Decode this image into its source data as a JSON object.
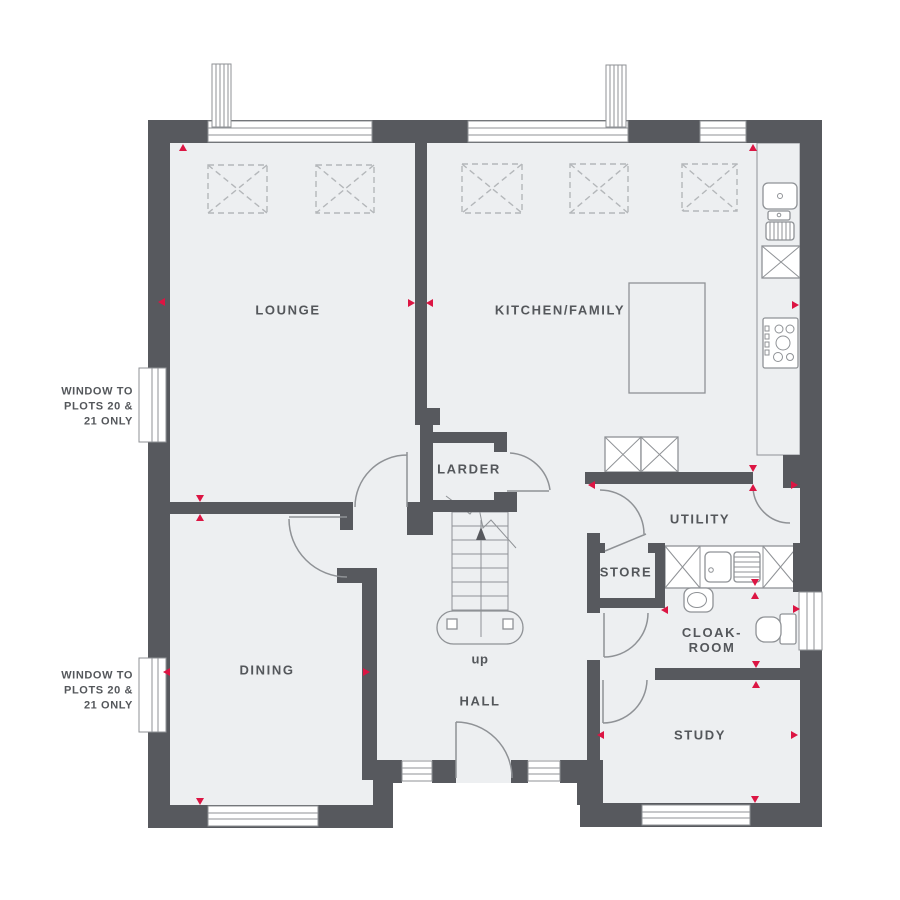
{
  "colors": {
    "wall": "#57595e",
    "floor": "#edeff1",
    "line": "#8f9296",
    "dash": "#b4b7ba",
    "accent": "#dc1543",
    "text": "#54575b"
  },
  "rooms": {
    "lounge": {
      "label": "LOUNGE"
    },
    "kitchen": {
      "label": "KITCHEN/FAMILY"
    },
    "larder": {
      "label": "LARDER"
    },
    "utility": {
      "label": "UTILITY"
    },
    "store": {
      "label": "STORE"
    },
    "cloakroom": {
      "label": "CLOAK-\nROOM"
    },
    "dining": {
      "label": "DINING"
    },
    "hall": {
      "label": "HALL"
    },
    "study": {
      "label": "STUDY"
    }
  },
  "stairs": {
    "direction_label": "up"
  },
  "notes": {
    "window_plots": "WINDOW TO\nPLOTS 20 &\n21 ONLY"
  },
  "icons": {
    "roof_lantern": "dashed-x-box",
    "chimney": "hatched-rect",
    "appliance": "x-box",
    "kitchen_sink": "basin-with-drainer",
    "utility_sink": "basin-with-drainer",
    "hob": "burner-circles",
    "wc": "toilet-with-cistern",
    "wash_basin": "oval-basin",
    "stairs_direction": "dark-up-arrow",
    "dimension_marker": "red-triangle"
  }
}
